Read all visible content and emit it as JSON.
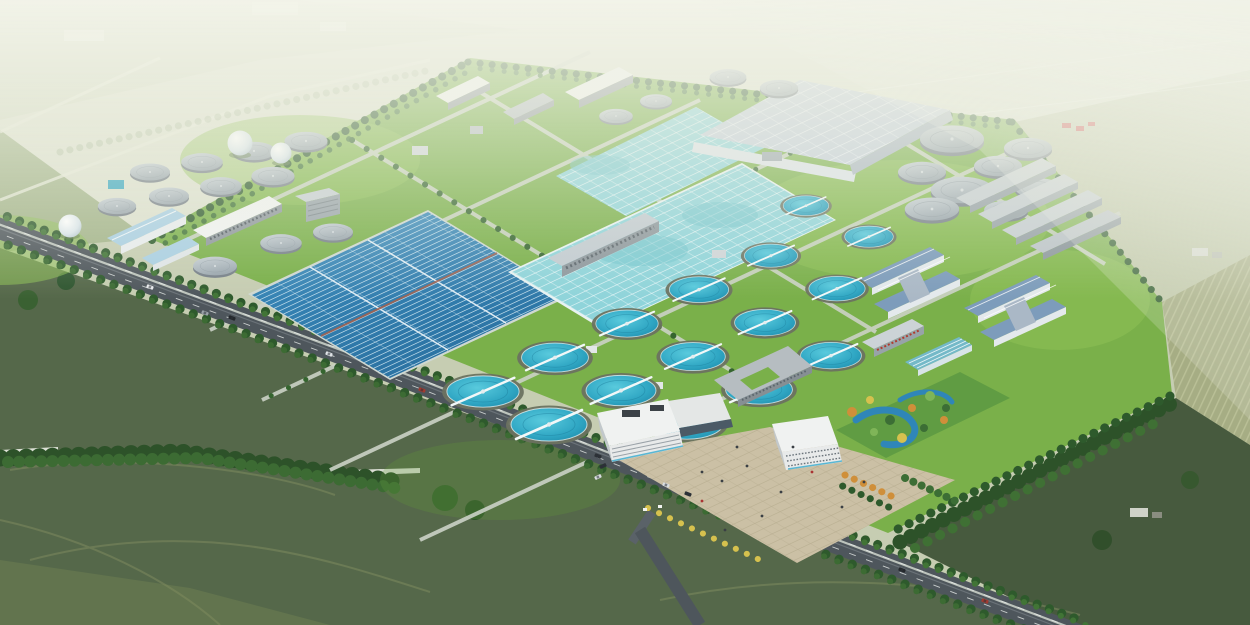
{
  "meta": {
    "subject": "Aerial architectural rendering of a large wastewater treatment plant campus set in green farmland",
    "view": "bird's-eye oblique perspective",
    "text_in_image": "none"
  },
  "palette": {
    "haze": "#dde1cf",
    "distant": "#c6cdb2",
    "field_mid": "#a3b48a",
    "field_dark": "#55684a",
    "field_darker": "#475a3e",
    "field_tan": "#a3aa7e",
    "lawn": "#7ab04a",
    "lawn_light": "#8ec157",
    "lawn_dark": "#649c3b",
    "road": "#4e565c",
    "road_minor": "#cbd2c6",
    "water_dark": "#2e7aad",
    "water_cyan": "#8fd4da",
    "water_teal": "#2aa4c4",
    "clarifier_rim": "#5f6b55",
    "roof_big": "#c3cedb",
    "roof_white": "#f0f2f1",
    "roof_blue": "#7d9cbb",
    "roof_sky": "#a9cfe3",
    "tank": "#9fa9b0",
    "tank_top": "#bcc6cc",
    "bldg": "#b5bdc2",
    "wall": "#8e979d",
    "tree_dark": "#2e5a2c",
    "tree_mid": "#417436",
    "plaza": "#cbc0a5",
    "pond": "#2f86b8",
    "autumn_orange": "#cf8f3a",
    "autumn_yellow": "#d6c14e",
    "accent_red": "#b03a2e"
  },
  "scene": {
    "site": {
      "label": "wastewater-treatment-plant-campus",
      "features": [
        "serpentine oxidation-ditch basin (dark blue)",
        "two turquoise aeration basin fields with walkway grid",
        "large pale covered-basin roof with panel grid",
        "circular secondary clarifiers with rotating bridge arms",
        "covered sludge digester tanks (grey tops)",
        "spherical biogas holders",
        "workshop and blower buildings",
        "administration buildings with white canopy roofs and paved plaza",
        "landscape garden with ponds and autumn trees"
      ],
      "clarifier_count": 15,
      "digester_tank_count": 15,
      "covered_round_tank_count": 8,
      "gas_sphere_count": 3
    },
    "surroundings": {
      "label": "rural-farmland",
      "features": [
        "tree-lined dual-carriageway arterial road running diagonally",
        "dark green crop fields with tractor tracks",
        "woodland bands and hedgerows",
        "striped cultivated fields and small farmsteads",
        "hazy distant fields at the horizon"
      ]
    }
  }
}
